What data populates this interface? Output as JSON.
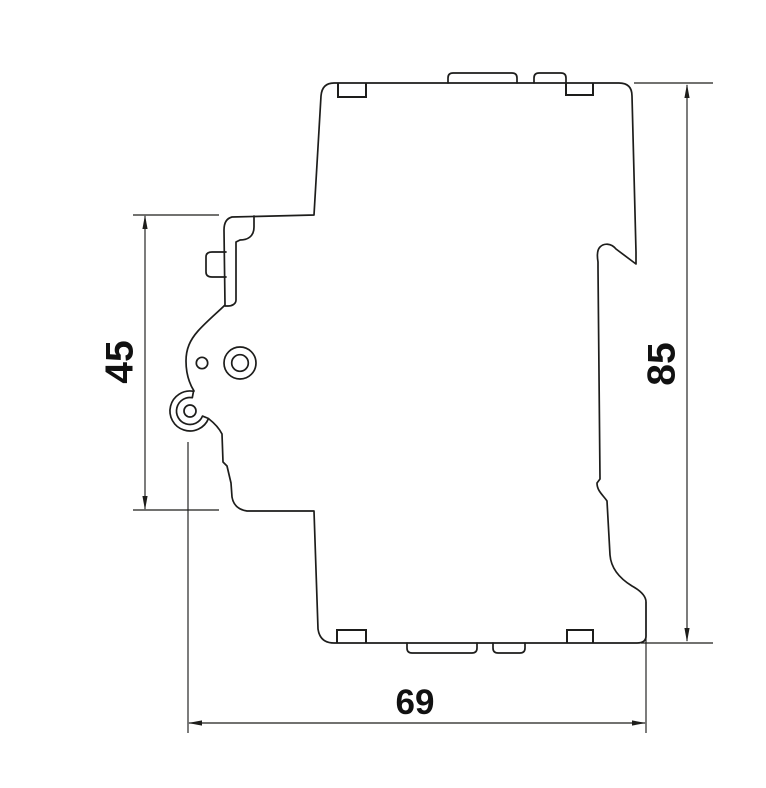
{
  "page": {
    "background_color": "#ffffff",
    "stroke_color": "#1d1d1b"
  },
  "drawing": {
    "view": "side-profile-outline",
    "dimension_labels": {
      "front_height": "45",
      "overall_height": "85",
      "overall_depth": "69"
    }
  }
}
